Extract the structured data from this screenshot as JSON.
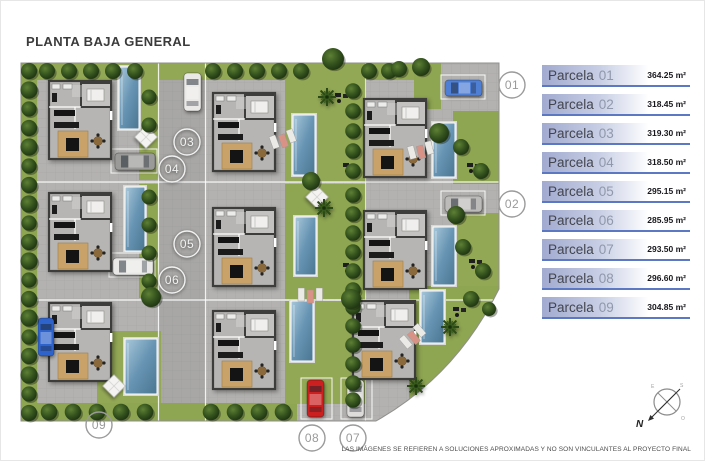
{
  "title": "PLANTA BAJA GENERAL",
  "legend": {
    "items": [
      {
        "name": "Parcela",
        "number": "01",
        "area": "364.25 m²"
      },
      {
        "name": "Parcela",
        "number": "02",
        "area": "318.45 m²"
      },
      {
        "name": "Parcela",
        "number": "03",
        "area": "319.30 m²"
      },
      {
        "name": "Parcela",
        "number": "04",
        "area": "318.50 m²"
      },
      {
        "name": "Parcela",
        "number": "05",
        "area": "295.15 m²"
      },
      {
        "name": "Parcela",
        "number": "06",
        "area": "285.95 m²"
      },
      {
        "name": "Parcela",
        "number": "07",
        "area": "293.50 m²"
      },
      {
        "name": "Parcela",
        "number": "08",
        "area": "296.60 m²"
      },
      {
        "name": "Parcela",
        "number": "09",
        "area": "304.85 m²"
      }
    ]
  },
  "plan": {
    "markers": [
      {
        "label": "01",
        "variant": "gray"
      },
      {
        "label": "02",
        "variant": "gray"
      },
      {
        "label": "03",
        "variant": "white"
      },
      {
        "label": "04",
        "variant": "white"
      },
      {
        "label": "05",
        "variant": "white"
      },
      {
        "label": "06",
        "variant": "white"
      },
      {
        "label": "07",
        "variant": "gray"
      },
      {
        "label": "08",
        "variant": "gray"
      },
      {
        "label": "09",
        "variant": "gray"
      }
    ]
  },
  "compass": {
    "n": "N",
    "e": "E",
    "s": "S",
    "o": "O"
  },
  "disclaimer": "LAS IMÁGENES SE REFIEREN A SOLUCIONES APROXIMADAS Y NO SON VINCULANTES AL PROYECTO FINAL",
  "colors": {
    "accent_blue": "#5d78c2",
    "legend_gradient_start": "#a2abd0",
    "pool_blue": "#6794b3",
    "grass_green": "#8ea551",
    "tree_green": "#2c4617",
    "pavement_gray": "#b3b2b0"
  }
}
